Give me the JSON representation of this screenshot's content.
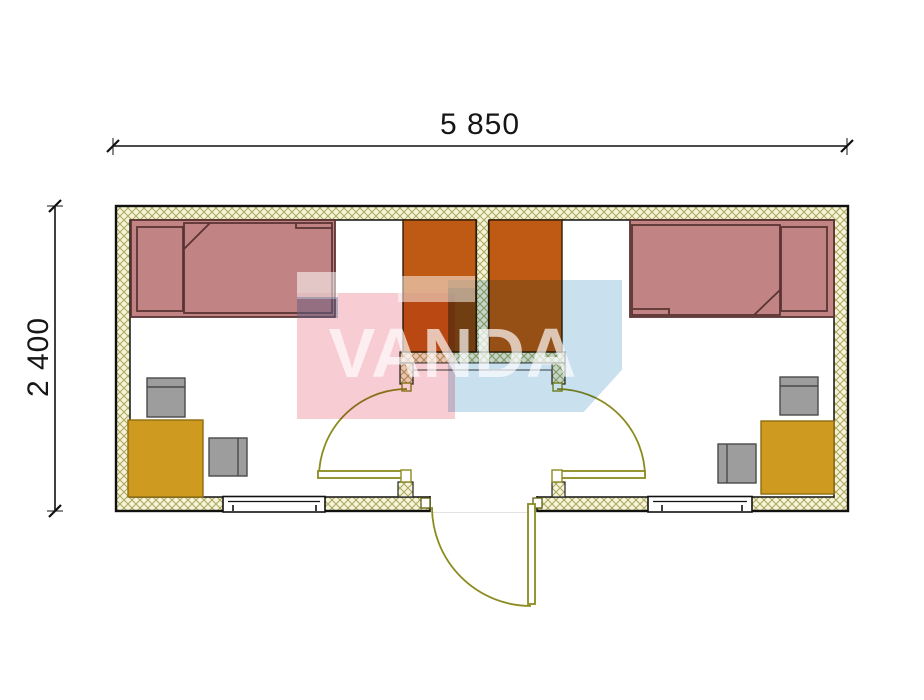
{
  "dimensions": {
    "width": "5 850",
    "height": "2 400"
  },
  "watermark": {
    "text": "VANDA",
    "pink_color": "#ef9aa5",
    "blue_color": "#9cc6e2"
  },
  "plan": {
    "type": "container-house-floor-plan",
    "wall_fill": "#f6f3da",
    "wall_hatch_color": "#a8a85a",
    "door_color": "#8b8b1e",
    "furniture": [
      {
        "item": "bed",
        "room": "left",
        "color": "#c18383"
      },
      {
        "item": "bed",
        "room": "right",
        "color": "#c18383"
      },
      {
        "item": "wardrobe",
        "room": "vestibule-left",
        "color": "#bf5a15"
      },
      {
        "item": "wardrobe",
        "room": "vestibule-right",
        "color": "#bf5a15"
      },
      {
        "item": "table",
        "room": "left",
        "color": "#ce9a1f"
      },
      {
        "item": "table",
        "room": "right",
        "color": "#ce9a1f"
      },
      {
        "item": "chair",
        "room": "left",
        "color": "#9d9d9d"
      },
      {
        "item": "chair",
        "room": "left",
        "color": "#9d9d9d"
      },
      {
        "item": "chair",
        "room": "right",
        "color": "#9d9d9d"
      },
      {
        "item": "chair",
        "room": "right",
        "color": "#9d9d9d"
      }
    ],
    "openings": [
      {
        "item": "window",
        "wall": "bottom-left"
      },
      {
        "item": "window",
        "wall": "bottom-right"
      },
      {
        "item": "entrance-door",
        "wall": "bottom-center"
      },
      {
        "item": "interior-door",
        "room": "left"
      },
      {
        "item": "interior-door",
        "room": "right"
      }
    ]
  }
}
